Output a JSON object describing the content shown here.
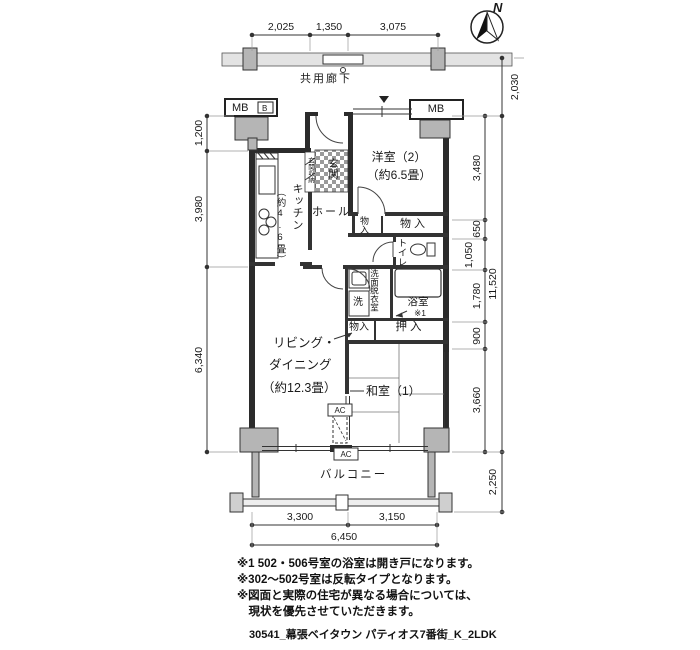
{
  "compass": {
    "north_label": "N"
  },
  "corridor": {
    "label": "共用廊下"
  },
  "rooms": {
    "western2_name": "洋室（2）",
    "western2_size": "（約6.5畳）",
    "kitchen_name": "キッチン",
    "kitchen_size": "（約4.6畳）",
    "hall": "ホール",
    "entrance": "玄関",
    "entrance_storage": "玄関収納",
    "storage_small": "物入",
    "storage_large": "物入",
    "toilet": "トイレ",
    "washroom": "洗面脱衣室",
    "laundry": "洗",
    "bathroom": "浴室",
    "bathroom_note_ref": "※1",
    "storage_bottom": "物入",
    "closet": "押入",
    "living_line1": "リビング・",
    "living_line2": "ダイニング",
    "living_line3": "（約12.3畳）",
    "japanese1": "和室（1）",
    "balcony": "バルコニー",
    "mb_left": "MB",
    "mb_left_b": "B",
    "mb_right": "MB",
    "ac_indoor": "AC",
    "ac_outdoor": "AC"
  },
  "dims": {
    "top": [
      "2,025",
      "1,350",
      "3,075"
    ],
    "left": [
      "1,200",
      "3,980",
      "6,340"
    ],
    "right_inner": [
      "3,480",
      "650",
      "1,050",
      "1,780",
      "900",
      "3,660"
    ],
    "right_corridor": "2,030",
    "right_total": "11,520",
    "right_balcony": "2,250",
    "bottom": [
      "3,300",
      "3,150"
    ],
    "bottom_total": "6,450"
  },
  "notes": [
    "※1 502・506号室の浴室は開き戸になります。",
    "※302〜502号室は反転タイプとなります。",
    "※図面と実際の住宅が異なる場合については、",
    "　現状を優先させていただきます。"
  ],
  "caption": "30541_幕張ベイタウン パティオス7番街_K_2LDK",
  "colors": {
    "wall": "#2b2b2b",
    "column_fill": "#b5b5b5",
    "line": "#444444"
  }
}
